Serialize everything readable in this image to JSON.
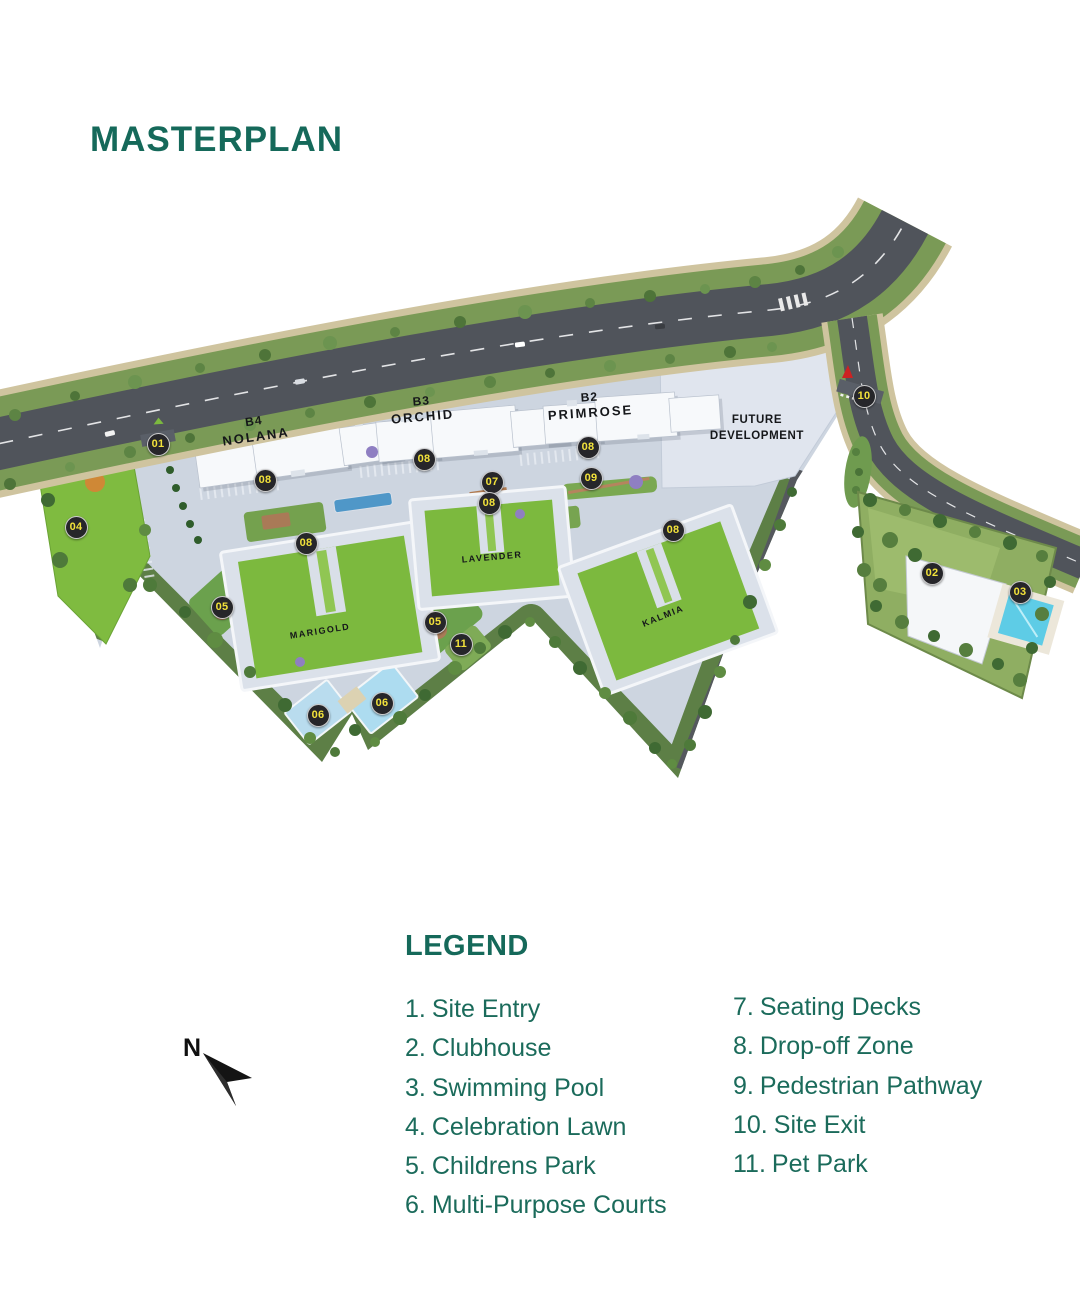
{
  "title": "MASTERPLAN",
  "colors": {
    "accent_teal": "#15695a",
    "lawn_green": "#7cb93e",
    "road_gray": "#50545b",
    "podium_gray": "#cdd5e0",
    "pool_cyan": "#5ecce6",
    "court_blue": "#b9dcee",
    "marker_bg": "#26262a",
    "marker_number_yellow": "#f2e23b"
  },
  "map": {
    "buildings": [
      {
        "code": "B4",
        "name": "NOLANA"
      },
      {
        "code": "B3",
        "name": "ORCHID"
      },
      {
        "code": "B2",
        "name": "PRIMROSE"
      }
    ],
    "lawns": [
      "MARIGOLD",
      "LAVENDER",
      "KALMIA"
    ],
    "future_development": "FUTURE DEVELOPMENT",
    "markers": [
      {
        "num": "01",
        "x": 158,
        "y": 444
      },
      {
        "num": "02",
        "x": 932,
        "y": 573
      },
      {
        "num": "03",
        "x": 1020,
        "y": 592
      },
      {
        "num": "04",
        "x": 76,
        "y": 527
      },
      {
        "num": "05",
        "x": 222,
        "y": 607
      },
      {
        "num": "05",
        "x": 435,
        "y": 622
      },
      {
        "num": "06",
        "x": 318,
        "y": 715
      },
      {
        "num": "06",
        "x": 382,
        "y": 703
      },
      {
        "num": "07",
        "x": 492,
        "y": 482
      },
      {
        "num": "08",
        "x": 265,
        "y": 480
      },
      {
        "num": "08",
        "x": 424,
        "y": 459
      },
      {
        "num": "08",
        "x": 588,
        "y": 447
      },
      {
        "num": "08",
        "x": 489,
        "y": 503
      },
      {
        "num": "08",
        "x": 306,
        "y": 543
      },
      {
        "num": "08",
        "x": 673,
        "y": 530
      },
      {
        "num": "09",
        "x": 591,
        "y": 478
      },
      {
        "num": "10",
        "x": 864,
        "y": 396
      },
      {
        "num": "11",
        "x": 461,
        "y": 644
      }
    ]
  },
  "legend": {
    "heading": "LEGEND",
    "columns": [
      [
        {
          "num": "1.",
          "label": "Site Entry"
        },
        {
          "num": "2.",
          "label": "Clubhouse"
        },
        {
          "num": "3.",
          "label": "Swimming Pool"
        },
        {
          "num": "4.",
          "label": "Celebration Lawn"
        },
        {
          "num": "5.",
          "label": "Childrens Park"
        },
        {
          "num": "6.",
          "label": "Multi-Purpose Courts"
        }
      ],
      [
        {
          "num": "7.",
          "label": "Seating Decks"
        },
        {
          "num": "8.",
          "label": "Drop-off Zone"
        },
        {
          "num": "9.",
          "label": "Pedestrian Pathway"
        },
        {
          "num": "10.",
          "label": "Site Exit"
        },
        {
          "num": "11.",
          "label": "Pet Park"
        }
      ]
    ]
  },
  "compass": {
    "label": "N"
  }
}
